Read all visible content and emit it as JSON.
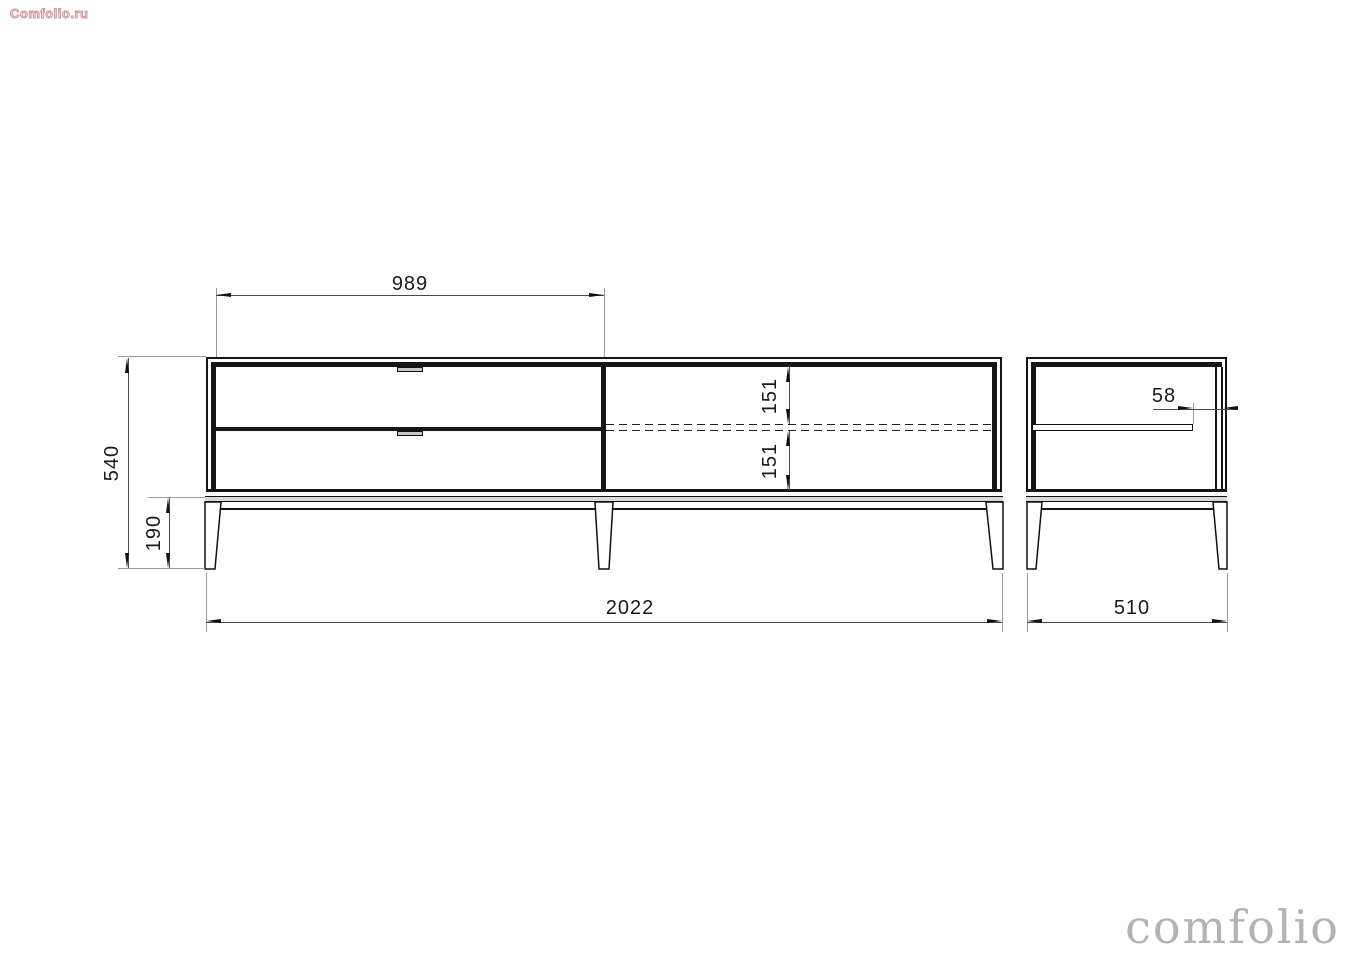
{
  "watermarks": {
    "top_left": "Comfolio.ru",
    "bottom_right": "comfolio"
  },
  "drawing": {
    "type": "furniture-technical-drawing",
    "front_view": {
      "dims": {
        "drawer_section_width": "989",
        "total_height": "540",
        "leg_height": "190",
        "shelf_gap_top": "151",
        "shelf_gap_bottom": "151",
        "total_width": "2022"
      }
    },
    "side_view": {
      "dims": {
        "shelf_back_offset": "58",
        "depth": "510"
      }
    },
    "colors": {
      "object_line": "#161616",
      "dimension_line": "#4a4a4a",
      "extension_line": "#9a9a9a",
      "plinth_fill": "#d9d9d9",
      "watermark_gray": "#b3b3b3",
      "watermark_red": "#cf9090",
      "background": "#ffffff"
    }
  }
}
